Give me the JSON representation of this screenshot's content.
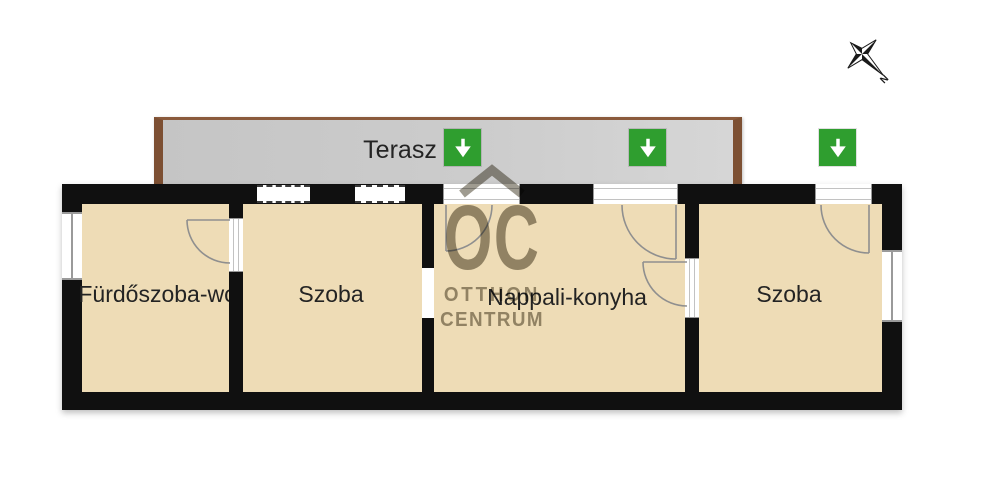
{
  "plan": {
    "type": "floor-plan",
    "terrace": {
      "label": "Terasz"
    },
    "rooms": [
      {
        "id": "bathroom-wc",
        "label": "Fürdőszoba-wc"
      },
      {
        "id": "room-left",
        "label": "Szoba"
      },
      {
        "id": "living-kitchen",
        "label": "Nappali-konyha"
      },
      {
        "id": "room-right",
        "label": "Szoba"
      }
    ],
    "entrances": {
      "count": 3,
      "icon": "green-down-arrow"
    },
    "compass": {
      "label": "N"
    },
    "watermark": {
      "monogram": "OC",
      "name_line1": "OTTHON",
      "name_line2": "CENTRUM"
    },
    "colors": {
      "wall": "#101010",
      "room_fill": "#eedcb6",
      "terrace_fill": "#cbcbcb",
      "terrace_trim": "#7d5033",
      "entrance_green": "#2f9e2f",
      "arrow_glyph": "#ffffff",
      "watermark_gray": "#8a8577",
      "label_text": "#232323"
    }
  }
}
